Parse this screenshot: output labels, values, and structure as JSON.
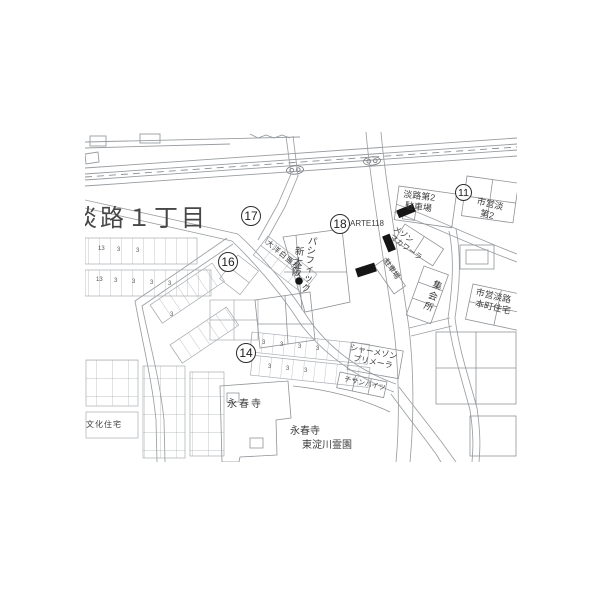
{
  "map": {
    "district_label": "淡路１丁目",
    "markers": {
      "m11": "11",
      "m14": "14",
      "m16": "16",
      "m17": "17",
      "m18": "18"
    },
    "labels": {
      "parking2_l1": "淡路第2",
      "parking2_l2": "駐車場",
      "municipal2_l1": "市営淡",
      "municipal2_l2": "第2",
      "arte": "ARTE118",
      "maison_l1": "メゾン",
      "maison_l2": "マカワーラ",
      "parking_small": "駐車場",
      "meeting_hall": "集会所",
      "honmachi_l1": "市営淡路",
      "honmachi_l2": "本町住宅",
      "taiyo": "大洋白亜棟",
      "pacific_l1": "新大阪",
      "pacific_l2": "パシフィック",
      "shamaison_l1": "シャーメゾン",
      "shamaison_l2": "プリメーラ",
      "chisan": "チサンハイツ",
      "temple": "永春寺",
      "cemetery_l1": "永春寺",
      "cemetery_l2": "東淀川霊園",
      "bunka": "文化住宅"
    },
    "parcel_numbers": [
      "13",
      "3",
      "3",
      "13",
      "3",
      "3",
      "3",
      "3",
      "3",
      "3",
      "3",
      "3",
      "3",
      "3",
      "3",
      "3"
    ],
    "colors": {
      "line": "#9b9fa3",
      "building": "#8f9397",
      "solid": "#151515",
      "text": "#3d3d3d"
    }
  }
}
